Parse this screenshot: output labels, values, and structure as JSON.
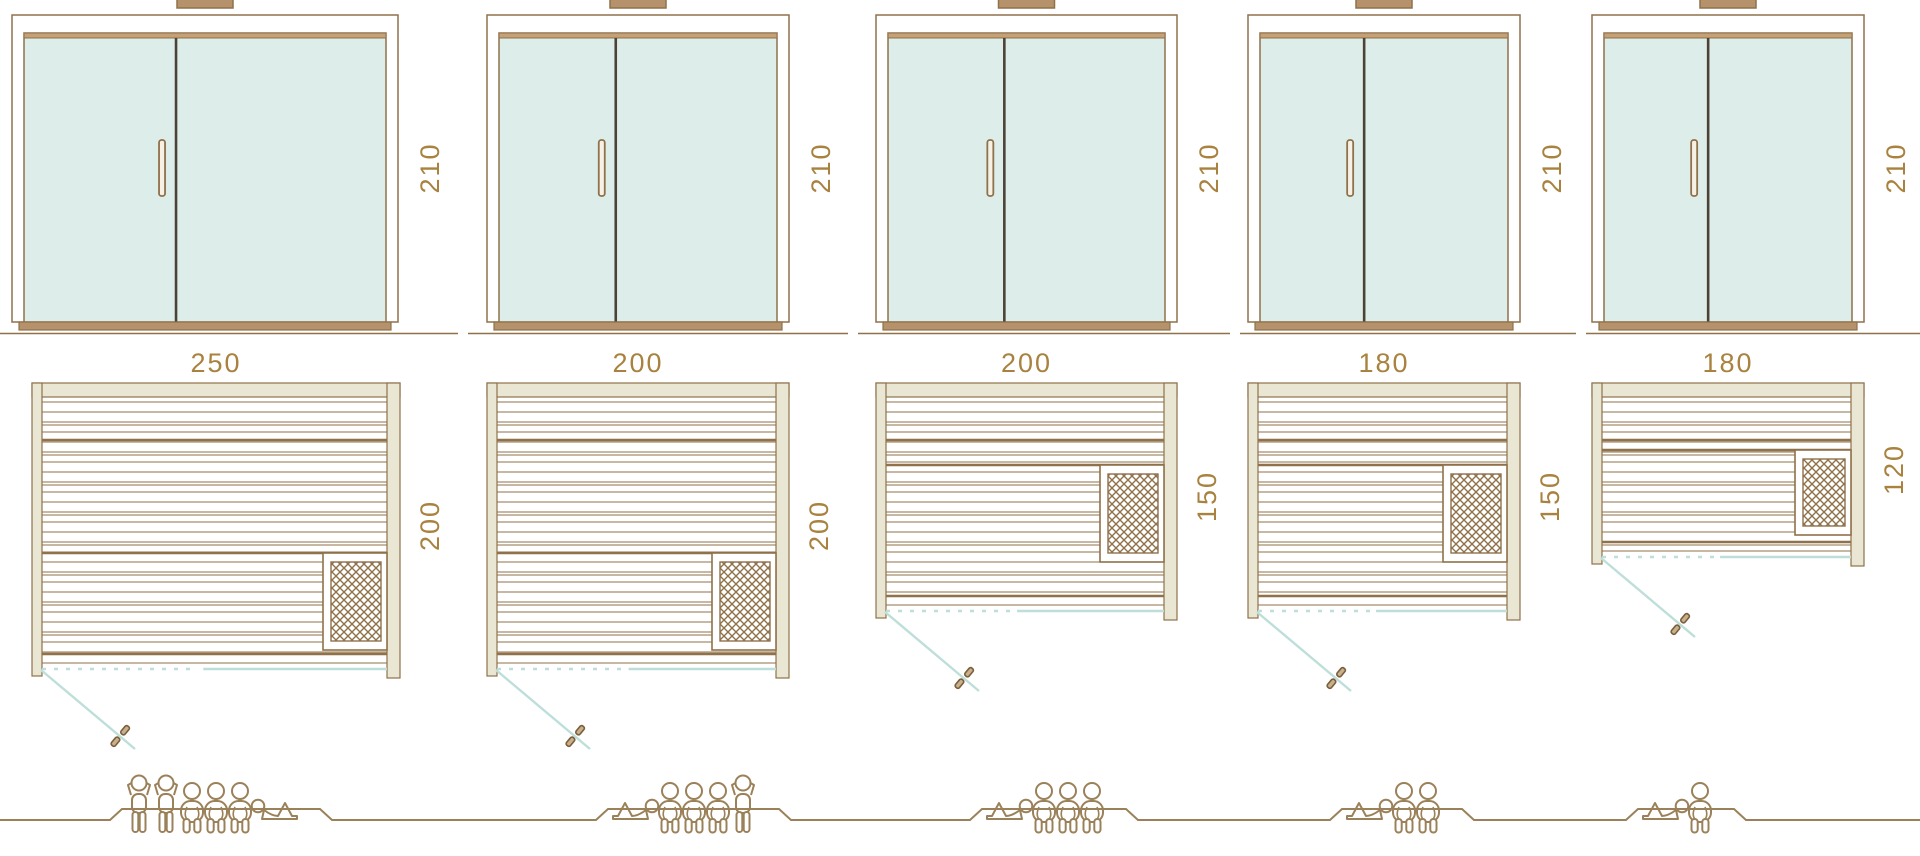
{
  "diagram": {
    "type": "sauna-size-comparison",
    "rows": [
      "door-elevation",
      "floor-plan",
      "capacity-pictograms"
    ]
  },
  "colors": {
    "line_brown": "#8f714a",
    "people_brown": "#9b8159",
    "label_gold": "#a8823e",
    "glass_teal": "#ddeeea",
    "wall_beige": "#e9e6d3",
    "teal_line": "#bedfd9",
    "dark_divider": "#4d4237",
    "wood_tan": "#b5926b",
    "rail_tan": "#c4a177",
    "handle_fill": "#f6f1e6"
  },
  "icons": {
    "door": "double-glass-door-icon",
    "heater": "heater-grid-icon",
    "swing": "door-swing-icon",
    "handle": "door-handle-icon",
    "standing": "standing-person-icon",
    "seated": "seated-person-icon",
    "lying": "lying-person-icon"
  },
  "models": [
    {
      "door_height_cm": "210",
      "width_cm": "250",
      "depth_cm": "200",
      "capacity_total": 6,
      "capacity": {
        "standing": 2,
        "seated": 3,
        "lying": 1
      }
    },
    {
      "door_height_cm": "210",
      "width_cm": "200",
      "depth_cm": "200",
      "capacity_total": 5,
      "capacity": {
        "standing": 1,
        "seated": 3,
        "lying": 1
      }
    },
    {
      "door_height_cm": "210",
      "width_cm": "200",
      "depth_cm": "150",
      "capacity_total": 4,
      "capacity": {
        "standing": 0,
        "seated": 3,
        "lying": 1
      }
    },
    {
      "door_height_cm": "210",
      "width_cm": "180",
      "depth_cm": "150",
      "capacity_total": 3,
      "capacity": {
        "standing": 0,
        "seated": 2,
        "lying": 1
      }
    },
    {
      "door_height_cm": "210",
      "width_cm": "180",
      "depth_cm": "120",
      "capacity_total": 2,
      "capacity": {
        "standing": 0,
        "seated": 1,
        "lying": 1
      }
    }
  ]
}
